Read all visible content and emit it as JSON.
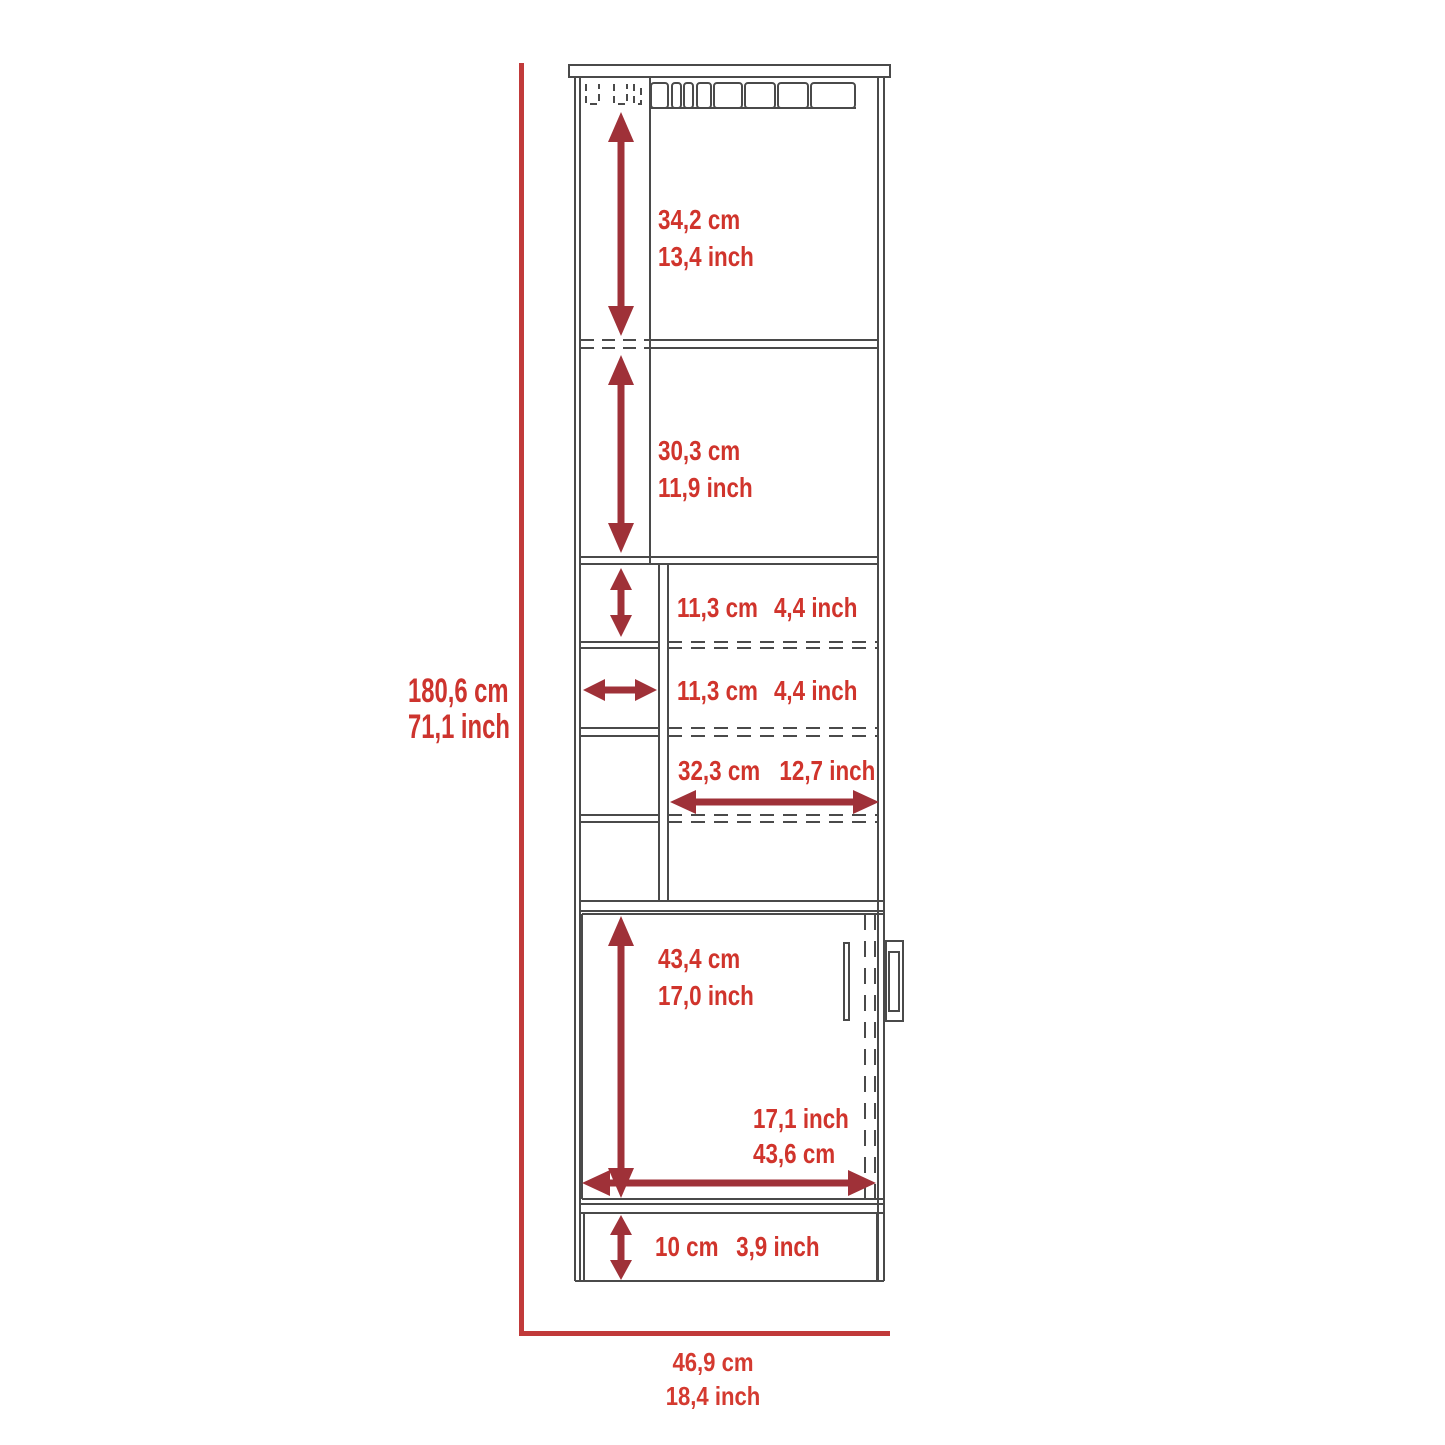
{
  "figure_title": "Bar cabinet dimension diagram",
  "colors": {
    "dimension_label": "#d0342c",
    "dimension_arrow": "#9f3138",
    "overall_dimension_line": "#c13a3a",
    "cabinet_outline": "#4a4a4a"
  },
  "labels": {
    "overall_height": {
      "metric": "180,6 cm",
      "imperial": "71,1 inch"
    },
    "overall_width": {
      "metric": "46,9 cm",
      "imperial": "18,4 inch"
    },
    "top_section": {
      "metric": "34,2 cm",
      "imperial": "13,4 inch"
    },
    "second_section": {
      "metric": "30,3 cm",
      "imperial": "11,9 inch"
    },
    "cubby_height": {
      "metric": "11,3 cm",
      "imperial": "4,4 inch"
    },
    "cubby_width": {
      "metric": "11,3 cm",
      "imperial": "4,4 inch"
    },
    "shelf_width": {
      "metric": "32,3 cm",
      "imperial": "12,7 inch"
    },
    "door_height": {
      "metric": "43,4 cm",
      "imperial": "17,0 inch"
    },
    "door_width": {
      "imperial": "17,1 inch",
      "metric": "43,6 cm"
    },
    "base_height": {
      "metric": "10 cm",
      "imperial": "3,9 inch"
    }
  }
}
